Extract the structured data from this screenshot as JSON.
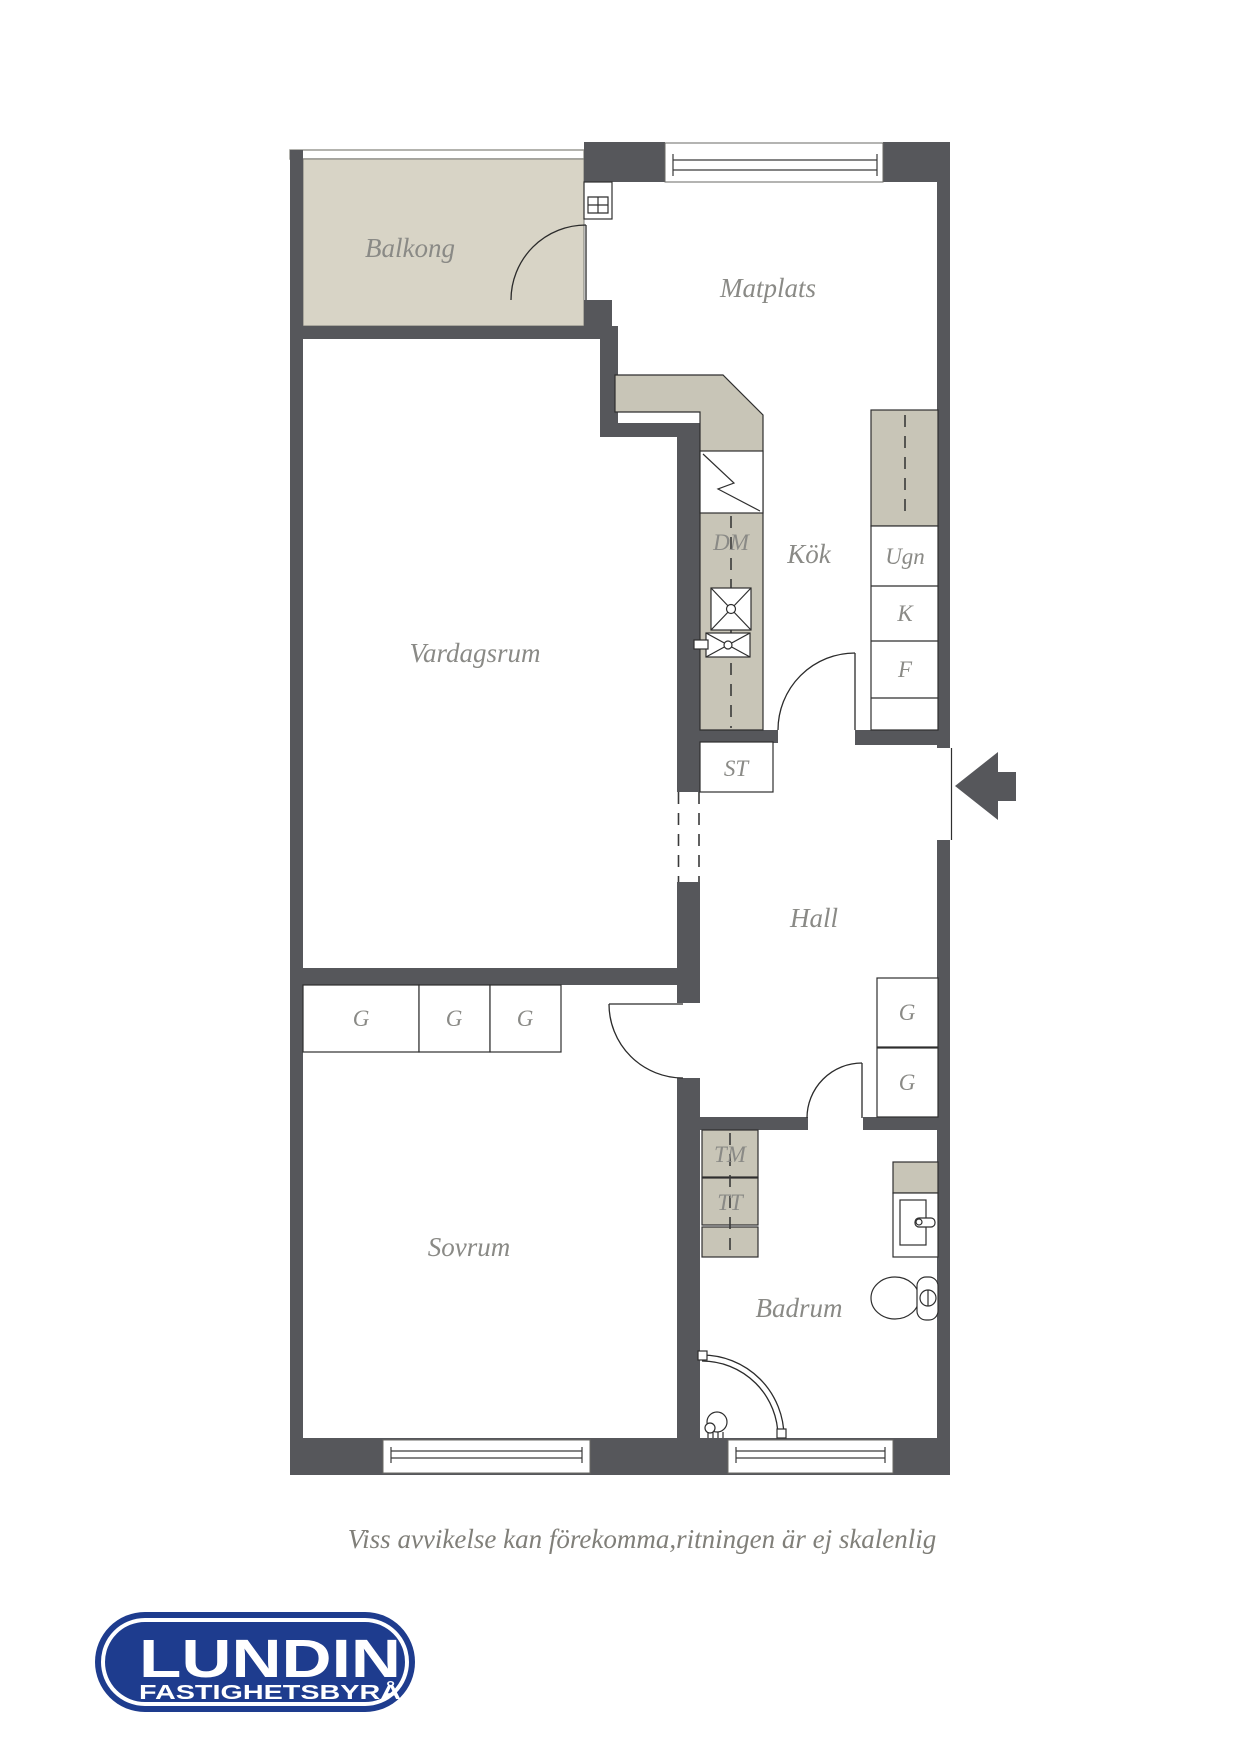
{
  "colors": {
    "wall": "#56575b",
    "balcony": "#d8d4c6",
    "counter": "#c8c5b7",
    "text": "#8a8a86",
    "logo_blue": "#1e3c8e"
  },
  "rooms": {
    "balcony": "Balkong",
    "dining": "Matplats",
    "kitchen": "Kök",
    "living": "Vardagsrum",
    "hall": "Hall",
    "bedroom": "Sovrum",
    "bathroom": "Badrum"
  },
  "labels": {
    "dishwasher": "DM",
    "oven": "Ugn",
    "fridge": "K",
    "freezer": "F",
    "cleaning_closet": "ST",
    "washing_machine": "TM",
    "dryer": "TT",
    "wardrobe": "G"
  },
  "disclaimer": "Viss avvikelse kan förekomma,ritningen är ej skalenlig",
  "logo": {
    "name": "LUNDIN",
    "tagline": "FASTIGHETSBYRÅ"
  }
}
